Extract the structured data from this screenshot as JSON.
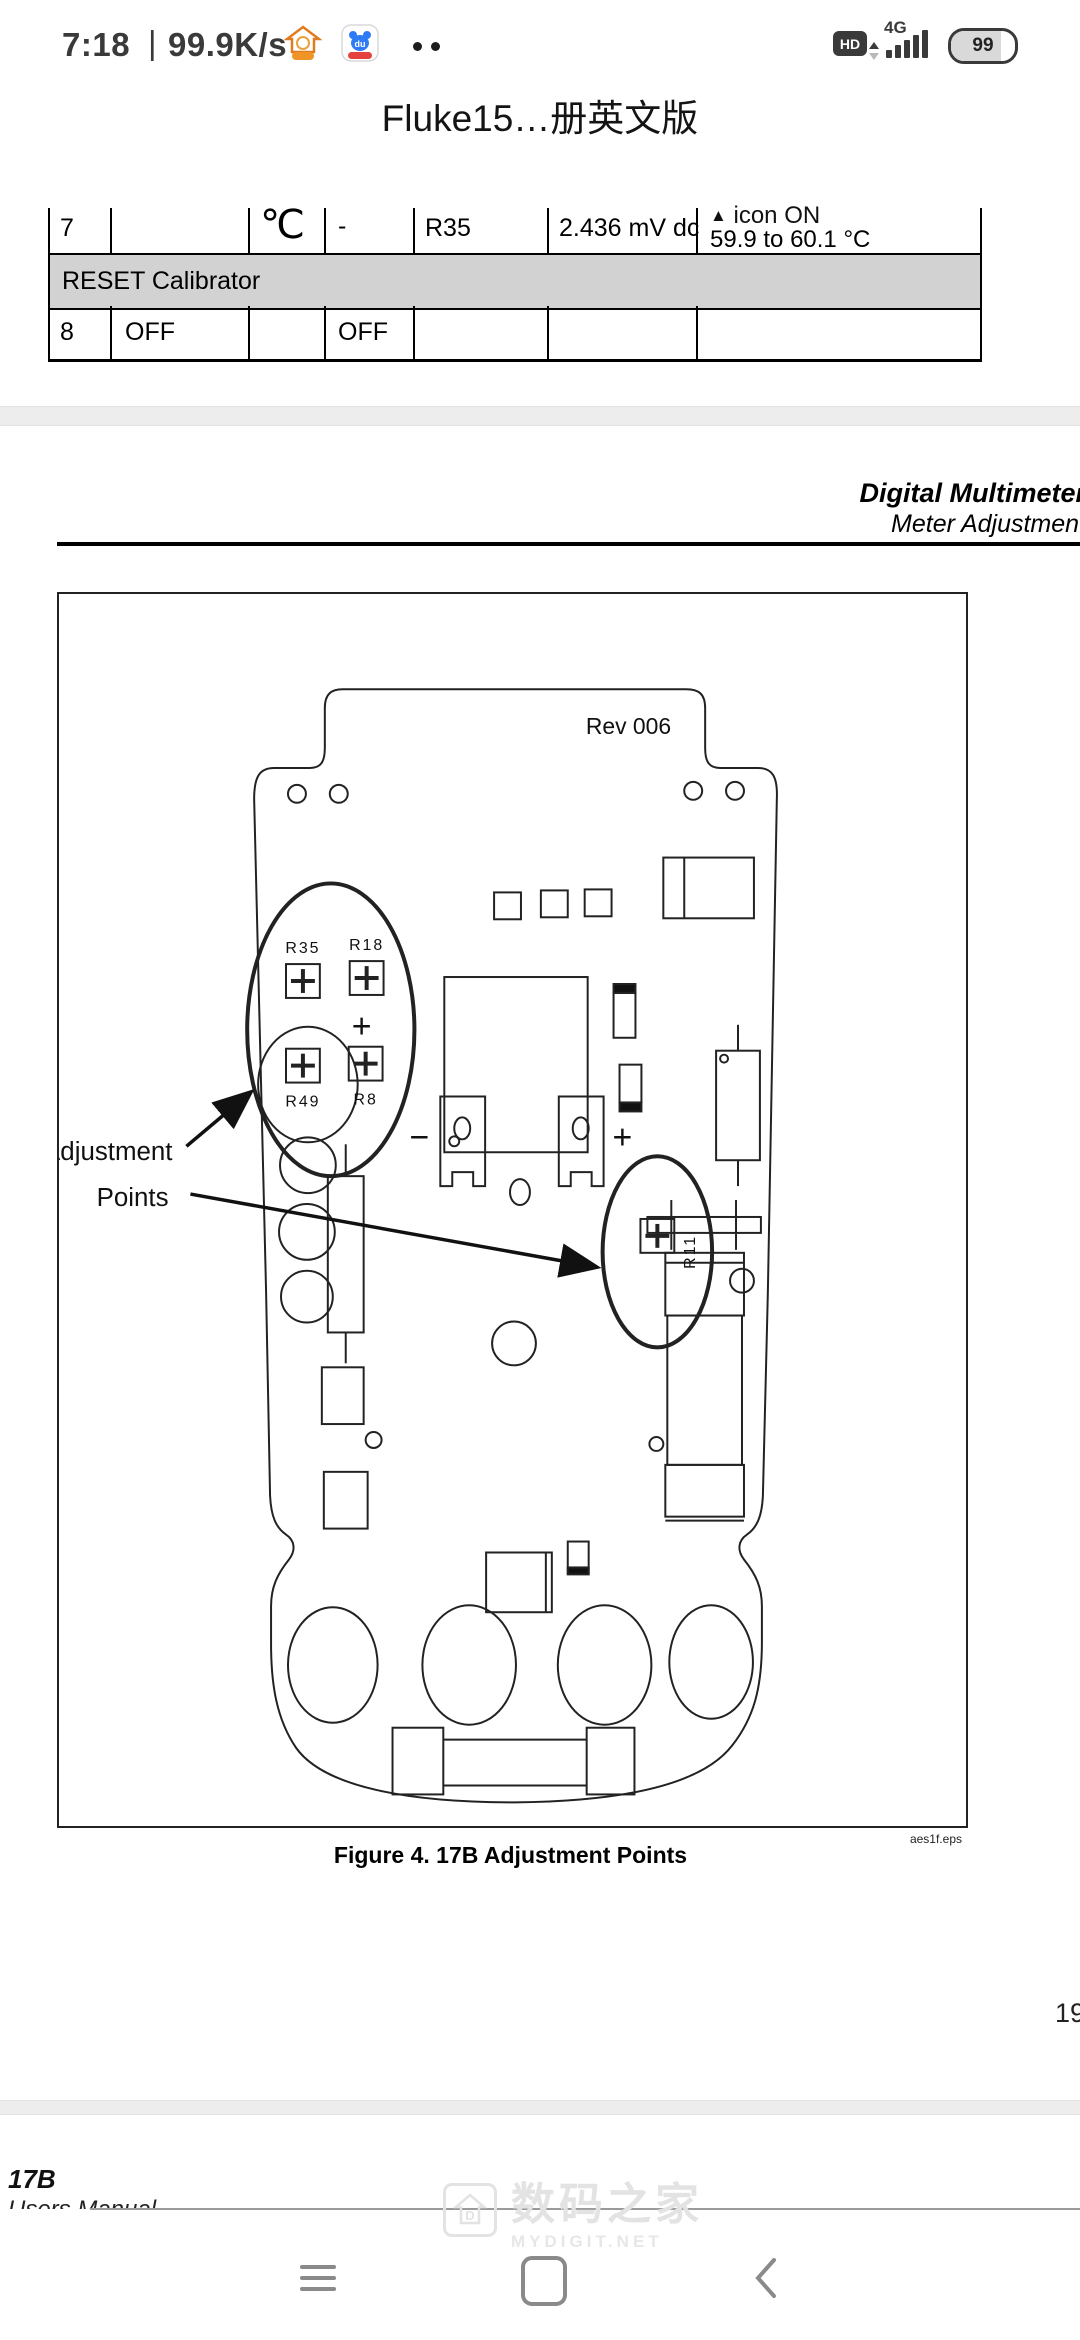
{
  "status_bar": {
    "time": "7:18",
    "separator": "|",
    "speed": "99.9K/s",
    "hd_badge": "HD",
    "network": "4G",
    "battery_level": "99"
  },
  "app_title": "Fluke15…册英文版",
  "table": {
    "row7": {
      "step": "7",
      "range": "℃",
      "dash": "-",
      "adjust": "R35",
      "value": "2.436 mV dc",
      "icon_char": "▲",
      "result_line1": "icon ON",
      "result_line2": "59.9 to 60.1 °C"
    },
    "reset_row": "RESET Calibrator",
    "row8": {
      "step": "8",
      "function": "OFF",
      "range": "OFF"
    }
  },
  "page_header": {
    "title": "Digital Multimeter",
    "subtitle": "Meter Adjustment"
  },
  "figure": {
    "rev": "Rev 006",
    "adjustment_label_line1": "Adjustment",
    "adjustment_label_line2": "Points",
    "trimmer_r35": "R35",
    "trimmer_r18": "R18",
    "trimmer_r49": "R49",
    "trimmer_r8": "R8",
    "trimmer_r11": "R11",
    "plus_sign": "+",
    "minus_sign": "−",
    "eps_credit": "aes1f.eps",
    "caption": "Figure 4. 17B Adjustment Points"
  },
  "page_number": "19",
  "next_page": {
    "section": "17B",
    "partial_text": "Users Manual"
  },
  "watermark": {
    "logo_letter": "D",
    "site_cn": "数码之家",
    "site_en": "MYDIGIT.NET"
  }
}
